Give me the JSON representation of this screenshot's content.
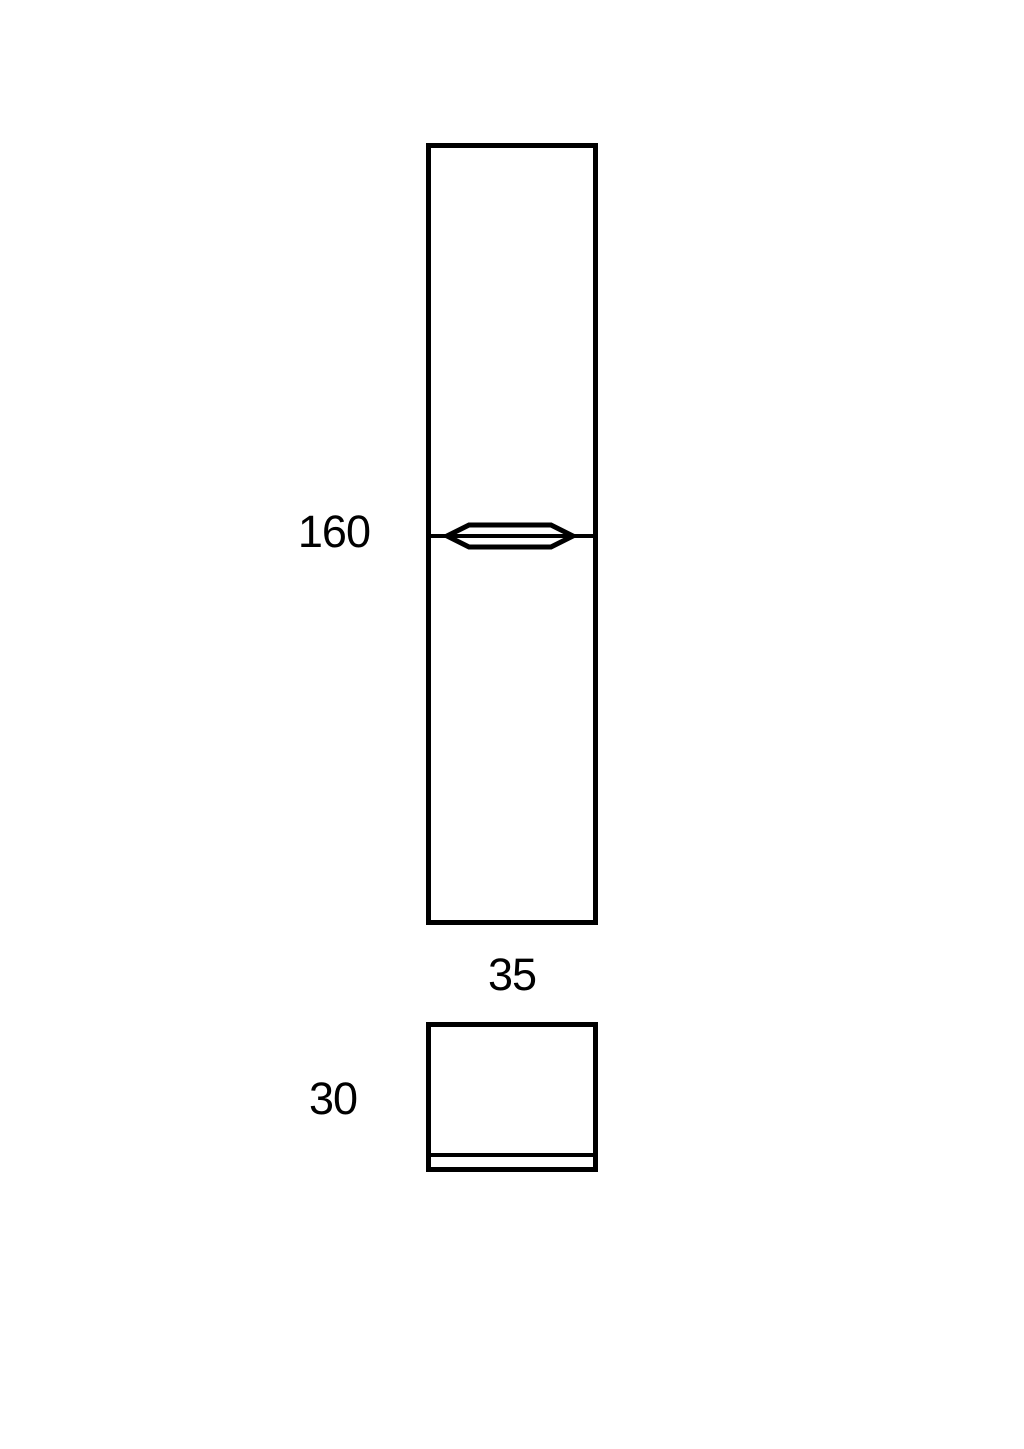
{
  "diagram": {
    "kind": "furniture-dimension-drawing",
    "background_color": "#ffffff",
    "line_color": "#000000",
    "text_color": "#000000",
    "front_view": {
      "height_label": "160",
      "width_label": "35"
    },
    "side_view": {
      "depth_label": "30"
    }
  }
}
